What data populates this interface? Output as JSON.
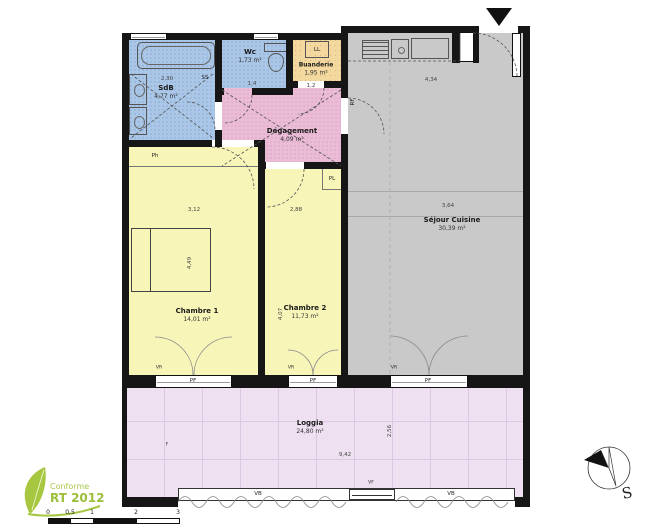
{
  "plan": {
    "rooms": {
      "sdb": {
        "label": "SdB",
        "area": "4,77 m²"
      },
      "wc": {
        "label": "Wc",
        "area": "1,73 m²"
      },
      "buanderie": {
        "label": "Buanderie",
        "area": "1,95 m²"
      },
      "degagement": {
        "label": "Dégagement",
        "area": "4,09 m²"
      },
      "sejour": {
        "label": "Séjour Cuisine",
        "area": "30,39 m²"
      },
      "chambre1": {
        "label": "Chambre 1",
        "area": "14,01 m²"
      },
      "chambre2": {
        "label": "Chambre 2",
        "area": "11,73 m²"
      },
      "loggia": {
        "label": "Loggia",
        "area": "24,80 m²"
      }
    },
    "tags": {
      "ll": "LL",
      "ss": "SS",
      "ph": "Ph",
      "pl": "PL",
      "rf": "RF",
      "pf": "PF",
      "vr": "VR",
      "vb": "VB",
      "vf": "VF",
      "f": "F"
    },
    "dimensions": {
      "sdb_w": "2,30",
      "wc_w": "1,4",
      "buanderie_w": "1,2",
      "kitchen_w": "4,34",
      "sejour_w": "3,64",
      "chambre1_w": "3,12",
      "chambre2_w": "2,88",
      "chambre1_d": "4,49",
      "chambre2_d": "4,07",
      "loggia_w": "9,42",
      "loggia_d": "2,56"
    },
    "compass": {
      "south": "S"
    },
    "stamp": {
      "line1": "Conforme",
      "line2": "RT 2012"
    },
    "scalebar": {
      "ticks": [
        "0",
        "0,5",
        "1",
        "2",
        "3"
      ]
    }
  },
  "colors": {
    "wet": "#aac7e7",
    "laundry": "#f3d9a0",
    "hall": "#eabcd6",
    "bedroom": "#f8f5b8",
    "living": "#c9c9c9",
    "loggia": "#eee0f0",
    "wall": "#161616",
    "stamp": "#9cbe3b"
  }
}
